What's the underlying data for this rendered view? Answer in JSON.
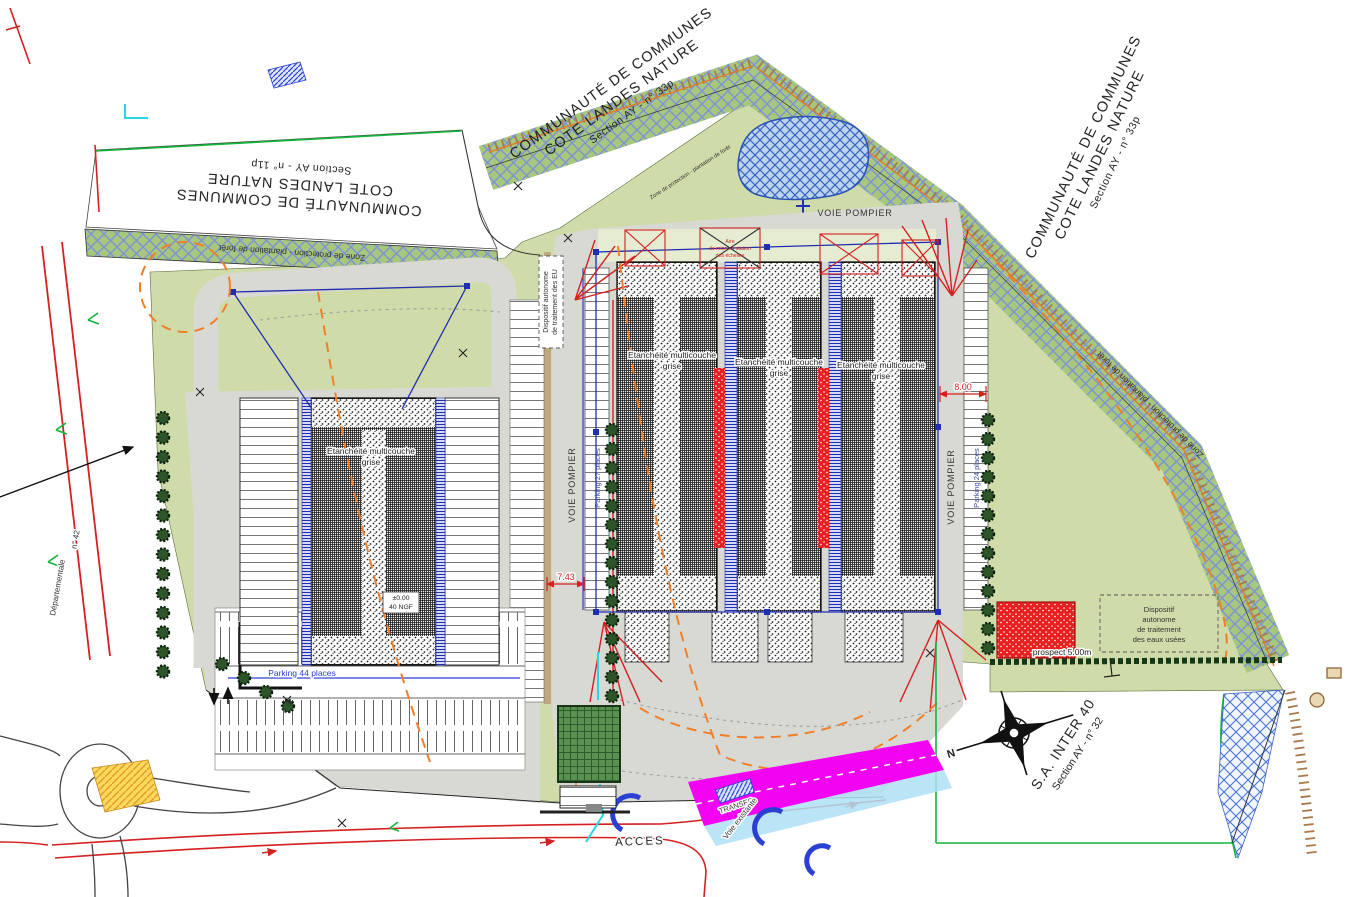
{
  "parcels": {
    "top_left": {
      "line1": "COMMUNAUTÉ DE COMMUNES",
      "line2": "COTE LANDES NATURE",
      "line3": "Section AY - n° 11p"
    },
    "top_center": {
      "line1": "COMMUNAUTÉ DE COMMUNES",
      "line2": "COTE LANDES NATURE",
      "line3": "Section AY - n° 33p"
    },
    "right": {
      "line1": "COMMUNAUTÉ DE COMMUNES",
      "line2": "COTE LANDES NATURE",
      "line3": "Section AY - n° 33p"
    },
    "bottom_right": {
      "line1": "S.A. INTER 40",
      "line2": "Section AY - n° 32"
    }
  },
  "zones": {
    "protection": "Zone de protection - plantation de forêt"
  },
  "roads": {
    "voie_pompier": "VOIE POMPIER",
    "acces": "ACCES",
    "voie_existante": "Voie existante",
    "departementale": "Départementale",
    "rd_number": "n° 42",
    "transfo": "TRANSFO"
  },
  "buildings": {
    "label_line1": "Etanchéité multicouche",
    "label_line2": "grise",
    "level_line1": "±0.00",
    "level_line2": "40 NGF"
  },
  "parking": {
    "left_strip": "Parking 27 places",
    "right_strip": "Parking 24 places",
    "south_lot": "Parking 44 places"
  },
  "equipment": {
    "dispositif_left_line1": "Dispositif autonome",
    "dispositif_left_line2": "de traitement des EU",
    "dispositif_right_line1": "Dispositif",
    "dispositif_right_line2": "autonome",
    "dispositif_right_line3": "de traitement",
    "dispositif_right_line4": "des eaux usées",
    "aire_line1": "Aire",
    "aire_line2": "de mise en station",
    "aire_line3": "des échelles"
  },
  "dimensions": {
    "dim_front": "8.00",
    "dim_side": "7.43",
    "prospect": "prospect 5.00m"
  },
  "compass": {
    "north": "N"
  },
  "colors": {
    "site_green": "#cfdca9",
    "band_green": "#a7c77c",
    "band_blue": "#7d92d8",
    "road_gray": "#d9d9d4",
    "red": "#d42020",
    "orange": "#f07f2a",
    "magenta": "#f203f2",
    "blue": "#2237b8",
    "water_blue": "#bdd4ef",
    "tan": "#a9794a",
    "tree_green": "#2e5429",
    "bright_green": "#12b53a",
    "cyan": "#26d6e3",
    "yellow": "#ffd95e"
  }
}
